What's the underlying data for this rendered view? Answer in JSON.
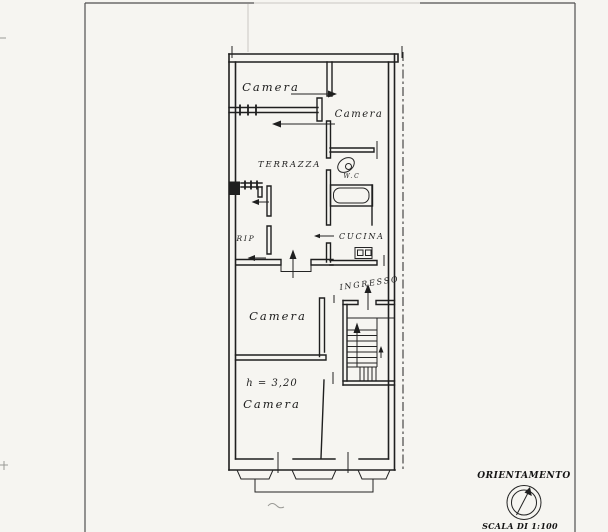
{
  "canvas": {
    "width": 608,
    "height": 532,
    "paper_color": "#f6f5f1",
    "ink_color": "#1f1f1f",
    "frame_color": "#4f4f4f"
  },
  "floor_plan": {
    "type": "apartment-floor-plan",
    "labels": {
      "camera_top_left": "Camera",
      "camera_top_right": "Camera",
      "terrazza": "TERRAZZA",
      "wc": "W.C",
      "rip": "RIP",
      "cucina": "CUCINA",
      "ingresso": "INGRESSO",
      "camera_middle": "Camera",
      "height_note": "h = 3,20",
      "camera_bottom": "Camera"
    },
    "icons": {
      "toilet": "toilet-icon",
      "bathtub": "bathtub-icon",
      "stove": "stove-icon",
      "stairs": "staircase-icon",
      "north_arrow": "compass-north-arrow-icon"
    }
  },
  "title_block": {
    "orientation_label": "ORIENTAMENTO",
    "scale_label": "SCALA DI 1:100"
  }
}
